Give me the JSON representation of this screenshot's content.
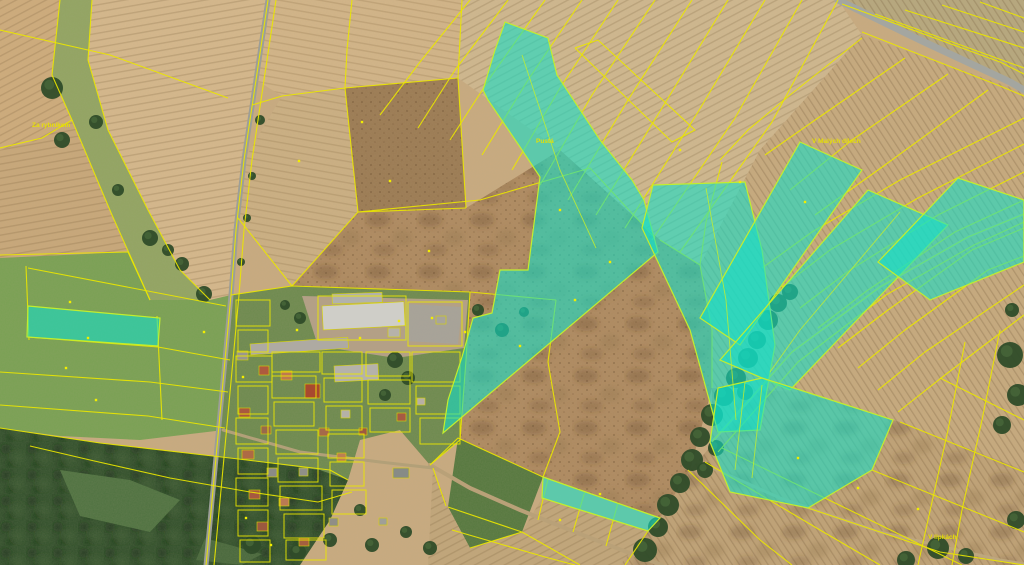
{
  "map": {
    "width": 1024,
    "height": 565,
    "base_color": "#c9ab80",
    "line_color": "#eae600",
    "highlight_fill": "#12e0c9",
    "highlight_stroke": "#c2ee2e",
    "label_color": "#e8e200",
    "marker_color": "#f2ee00",
    "fields": [
      {
        "name": "topleft-corner",
        "points": "0,0 60,0 52,75 72,120 40,140 0,150",
        "fill": "#cfac7c",
        "textures": [
          "rows60"
        ]
      },
      {
        "name": "green-corridor",
        "points": "60,0 92,0 88,60 108,130 148,210 180,270 210,300 150,300 112,215 72,120 52,75",
        "fill": "#92a562",
        "textures": []
      },
      {
        "name": "topleft-big",
        "points": "92,0 268,0 256,80 244,160 236,230 231,295 210,300 180,270 148,210 108,130 88,60",
        "fill": "#d6b88c",
        "textures": [
          "rows80"
        ]
      },
      {
        "name": "left-mid",
        "points": "0,150 40,140 72,120 112,215 128,252 28,258 0,258",
        "fill": "#c9a87a",
        "textures": [
          "rows80"
        ]
      },
      {
        "name": "meadow",
        "points": "0,258 128,252 150,300 210,300 231,295 228,380 224,430 140,440 60,436 0,428",
        "fill": "#79a153",
        "textures": []
      },
      {
        "name": "top-mid",
        "points": "268,0 462,0 458,78 345,88 282,96 256,80",
        "fill": "#d3b588",
        "textures": [
          "rows100"
        ]
      },
      {
        "name": "mid-strip",
        "points": "282,96 345,88 358,212 292,286 238,218 244,160",
        "fill": "#ccb083",
        "textures": [
          "rows100"
        ]
      },
      {
        "name": "brown-top",
        "points": "345,88 458,78 466,208 358,212",
        "fill": "#9c7b53",
        "textures": [
          "dots"
        ]
      },
      {
        "name": "top-center-right",
        "points": "462,0 838,0 862,35 760,150 700,265 660,240 560,150 458,78",
        "fill": "#d0b88f",
        "textures": [
          "rows60"
        ]
      },
      {
        "name": "ne-corner",
        "points": "842,0 1024,0 1024,88",
        "fill": "#b7a87e",
        "textures": [
          "rowsNeg"
        ]
      },
      {
        "name": "right-mid",
        "points": "862,35 1024,92 1024,470 900,422 800,392 712,388 712,330 700,265 760,150",
        "fill": "#c7aa7e",
        "textures": [
          "rowsNeg"
        ]
      },
      {
        "name": "rough-center",
        "points": "358,212 466,208 560,150 660,240 700,265 712,330 712,388 690,470 660,518 543,477 458,438 430,465 400,430 292,286",
        "fill": "#af8a60",
        "textures": [
          "dots",
          "mottle"
        ]
      },
      {
        "name": "green-bottom",
        "points": "458,438 543,477 522,532 470,548 448,507",
        "fill": "#55783e",
        "textures": []
      },
      {
        "name": "bottom-center",
        "points": "433,468 448,507 470,548 522,532 542,498 648,531 620,565 428,565",
        "fill": "#c2a67a",
        "textures": [
          "rows60"
        ]
      },
      {
        "name": "bottom-right",
        "points": "712,388 800,392 900,422 1024,470 1024,565 620,565 648,531 660,518 690,470 712,445",
        "fill": "#c0a276",
        "textures": [
          "rowsNeg",
          "mottle"
        ]
      },
      {
        "name": "village-gardens",
        "points": "231,295 292,286 470,292 466,360 460,440 430,465 400,430 360,440 348,480 330,520 300,565 206,565 213,490 219,425 225,360",
        "fill": "#6d8a4e",
        "textures": []
      },
      {
        "name": "farmyard",
        "points": "302,296 468,300 464,348 396,358 318,346",
        "fill": "#b4a086",
        "textures": []
      },
      {
        "name": "parking",
        "points": "406,304 462,307 458,344 404,341",
        "fill": "#a7a39a",
        "textures": []
      },
      {
        "name": "forest",
        "points": "0,428 100,443 230,458 320,470 348,480 330,520 300,565 0,565",
        "fill": "#31502b",
        "textures": [
          "canopy"
        ]
      },
      {
        "name": "glade-1",
        "points": "60,470 130,480 180,500 150,532 80,516",
        "fill": "#4e7240",
        "textures": []
      },
      {
        "name": "glade-2",
        "points": "205,538 262,554 242,565 196,560",
        "fill": "#47683b",
        "textures": []
      }
    ],
    "roads": [
      {
        "name": "main-road",
        "points": "268,0 256,80 244,160 236,230 231,295 225,360 219,425 213,490 207,555 206,565",
        "color": "#9c9e98",
        "width": 5
      },
      {
        "name": "highway-ne",
        "points": "838,0 920,40 1010,82 1024,90",
        "color": "#a4a6a0",
        "width": 7
      },
      {
        "name": "dirt-path-bottom",
        "points": "430,465 470,488 520,510 575,532 640,557 662,565",
        "color": "#b9a178",
        "width": 4
      },
      {
        "name": "dirt-path-right",
        "points": "690,458 780,498 880,532 1000,560 1024,564",
        "color": "#bda77e",
        "width": 3
      },
      {
        "name": "creek-track",
        "points": "712,442 792,352 880,287 968,237 1024,214",
        "color": "#c6ae83",
        "width": 3
      },
      {
        "name": "village-cross-street",
        "points": "223,430 300,452 380,462 433,468",
        "color": "#b2a078",
        "width": 3
      }
    ],
    "trees": [
      [
        645,
        550,
        12
      ],
      [
        658,
        527,
        10
      ],
      [
        668,
        505,
        11
      ],
      [
        680,
        483,
        10
      ],
      [
        692,
        460,
        11
      ],
      [
        700,
        437,
        10
      ],
      [
        712,
        415,
        11
      ],
      [
        724,
        396,
        10
      ],
      [
        736,
        378,
        10
      ],
      [
        748,
        358,
        10
      ],
      [
        757,
        340,
        9
      ],
      [
        768,
        320,
        10
      ],
      [
        778,
        303,
        9
      ],
      [
        790,
        292,
        8
      ],
      [
        705,
        470,
        8
      ],
      [
        716,
        448,
        8
      ],
      [
        745,
        392,
        8
      ],
      [
        52,
        88,
        11
      ],
      [
        62,
        140,
        8
      ],
      [
        96,
        122,
        7
      ],
      [
        118,
        190,
        6
      ],
      [
        150,
        238,
        8
      ],
      [
        182,
        264,
        7
      ],
      [
        204,
        294,
        8
      ],
      [
        168,
        250,
        6
      ],
      [
        260,
        120,
        5
      ],
      [
        252,
        176,
        4
      ],
      [
        247,
        218,
        4
      ],
      [
        241,
        262,
        4
      ],
      [
        1010,
        355,
        13
      ],
      [
        1018,
        395,
        11
      ],
      [
        1002,
        425,
        9
      ],
      [
        1012,
        310,
        7
      ],
      [
        938,
        548,
        11
      ],
      [
        906,
        560,
        9
      ],
      [
        1016,
        520,
        9
      ],
      [
        966,
        556,
        8
      ],
      [
        252,
        545,
        9
      ],
      [
        298,
        552,
        8
      ],
      [
        330,
        540,
        7
      ],
      [
        372,
        545,
        7
      ],
      [
        406,
        532,
        6
      ],
      [
        430,
        548,
        7
      ],
      [
        360,
        510,
        6
      ],
      [
        395,
        360,
        8
      ],
      [
        408,
        378,
        7
      ],
      [
        385,
        395,
        6
      ],
      [
        300,
        318,
        6
      ],
      [
        285,
        305,
        5
      ],
      [
        478,
        310,
        6
      ],
      [
        502,
        330,
        7
      ],
      [
        524,
        312,
        5
      ]
    ],
    "buildings": [
      {
        "x": 322,
        "y": 306,
        "w": 82,
        "h": 24,
        "fill": "#cfcec8",
        "rot": -3
      },
      {
        "x": 332,
        "y": 294,
        "w": 50,
        "h": 10,
        "fill": "#b2b2ac",
        "rot": -2
      },
      {
        "x": 250,
        "y": 344,
        "w": 98,
        "h": 11,
        "fill": "#aeaaa2",
        "rot": -4
      },
      {
        "x": 334,
        "y": 366,
        "w": 44,
        "h": 16,
        "fill": "#b5b2aa",
        "rot": -3
      },
      {
        "x": 305,
        "y": 384,
        "w": 15,
        "h": 14,
        "fill": "#a8492f",
        "rot": 0
      },
      {
        "x": 237,
        "y": 351,
        "w": 11,
        "h": 9,
        "fill": "#9a968e",
        "rot": 0
      },
      {
        "x": 259,
        "y": 366,
        "w": 10,
        "h": 9,
        "fill": "#ad5a3e",
        "rot": 0
      },
      {
        "x": 281,
        "y": 371,
        "w": 11,
        "h": 9,
        "fill": "#bd7950",
        "rot": 0
      },
      {
        "x": 239,
        "y": 408,
        "w": 11,
        "h": 9,
        "fill": "#a9593f",
        "rot": 0
      },
      {
        "x": 261,
        "y": 426,
        "w": 10,
        "h": 8,
        "fill": "#99694b",
        "rot": 0
      },
      {
        "x": 242,
        "y": 450,
        "w": 12,
        "h": 9,
        "fill": "#ae6a45",
        "rot": 0
      },
      {
        "x": 267,
        "y": 468,
        "w": 10,
        "h": 9,
        "fill": "#8b8b85",
        "rot": 0
      },
      {
        "x": 249,
        "y": 490,
        "w": 11,
        "h": 9,
        "fill": "#a65940",
        "rot": 0
      },
      {
        "x": 279,
        "y": 498,
        "w": 10,
        "h": 8,
        "fill": "#ba7a53",
        "rot": 0
      },
      {
        "x": 257,
        "y": 522,
        "w": 11,
        "h": 9,
        "fill": "#9b593f",
        "rot": 0
      },
      {
        "x": 299,
        "y": 468,
        "w": 9,
        "h": 8,
        "fill": "#8f8f88",
        "rot": 0
      },
      {
        "x": 319,
        "y": 428,
        "w": 10,
        "h": 8,
        "fill": "#a5694a",
        "rot": 0
      },
      {
        "x": 341,
        "y": 410,
        "w": 9,
        "h": 8,
        "fill": "#b5b1a8",
        "rot": 0
      },
      {
        "x": 359,
        "y": 428,
        "w": 8,
        "h": 7,
        "fill": "#9f5940",
        "rot": 0
      },
      {
        "x": 337,
        "y": 453,
        "w": 9,
        "h": 8,
        "fill": "#bd7f53",
        "rot": 0
      },
      {
        "x": 388,
        "y": 328,
        "w": 12,
        "h": 9,
        "fill": "#b6b2aa",
        "rot": 0
      },
      {
        "x": 299,
        "y": 538,
        "w": 10,
        "h": 8,
        "fill": "#a55f3f",
        "rot": 0
      },
      {
        "x": 329,
        "y": 518,
        "w": 9,
        "h": 8,
        "fill": "#908e86",
        "rot": 0
      },
      {
        "x": 397,
        "y": 413,
        "w": 9,
        "h": 8,
        "fill": "#a65b43",
        "rot": 0
      },
      {
        "x": 417,
        "y": 398,
        "w": 8,
        "h": 7,
        "fill": "#b7afa5",
        "rot": 0
      },
      {
        "x": 379,
        "y": 518,
        "w": 8,
        "h": 7,
        "fill": "#9f9f98",
        "rot": 0
      },
      {
        "x": 393,
        "y": 468,
        "w": 16,
        "h": 10,
        "fill": "#878b86",
        "rot": 0
      },
      {
        "x": 436,
        "y": 316,
        "w": 10,
        "h": 8,
        "fill": "#a8a49c",
        "rot": 0
      }
    ],
    "parcel_lines": [
      "0,30 110,55 228,98",
      "0,148 42,138 72,120",
      "60,0 52,75 72,120 112,215 150,300",
      "92,0 88,60 108,130 148,210 180,270 210,300",
      "0,255 128,252 150,300",
      "28,268 226,306",
      "27,337 158,347 230,360",
      "0,372 150,382 228,392",
      "0,405 148,416 225,428",
      "26,266 29,340",
      "157,316 162,420",
      "0,428 100,443 230,458 330,470 348,480",
      "30,446 90,460 170,478 250,492 318,502 352,492",
      "268,0 256,80 244,160 236,230 231,295 225,360 219,425 213,490 207,555 206,565",
      "276,0 264,80 252,160 244,230 239,295 233,360 227,425 221,490 215,555 214,565",
      "282,96 345,88 458,78",
      "352,0 347,50 345,88",
      "462,0 458,78 466,208",
      "358,212 466,208",
      "345,88 358,212",
      "252,105 282,96",
      "238,218 292,286 358,212",
      "231,295 292,286 470,292",
      "358,212 480,200 590,168 655,238",
      "660,240 700,265",
      "470,0 420,62 380,115",
      "508,0 455,70 418,128",
      "545,0 492,75 450,140",
      "582,0 528,80 482,155",
      "618,0 560,88 512,170",
      "655,0 592,95 540,185",
      "692,0 628,100 568,200",
      "728,0 662,108 596,215",
      "765,0 698,112 625,228",
      "802,0 735,118 652,240",
      "838,0 772,122 680,252",
      "575,48 598,40 695,130 672,142 575,48",
      "842,4 1000,62 1024,74",
      "862,32 1000,86 1024,96",
      "875,14 1024,68",
      "905,10 1024,48",
      "942,5 1024,32",
      "980,2 1024,18",
      "1024,118 900,180 812,232 762,268",
      "1024,144 918,198 830,250 782,287",
      "1024,172 938,215 850,270 800,308",
      "1024,200 955,232 868,290 818,328",
      "1024,228 972,250 888,310 838,348",
      "1024,256 988,270 905,330 858,368",
      "1024,285 925,352 878,390",
      "1024,315 945,375 898,412",
      "905,58 818,118 765,155",
      "948,74 852,140 790,190",
      "988,90 885,165 815,215",
      "862,38 790,95 748,130 720,160",
      "700,265 712,330 712,388",
      "722,162 706,222 700,265",
      "712,442 792,352 880,287 968,237 1024,214",
      "718,452 798,362 886,295 974,245 1024,222",
      "705,462 820,530 880,565",
      "722,448 870,520 962,565",
      "688,470 760,540 792,565",
      "900,422 1024,472",
      "872,470 1000,522 1024,532",
      "808,508 940,552 1024,565",
      "940,378 1024,420",
      "965,342 948,430 928,520 918,565",
      "1000,330 982,420 962,510 952,565",
      "430,465 458,438 543,477 660,518",
      "542,498 648,531",
      "448,507 522,532 580,565",
      "452,530 545,557 575,565",
      "470,548 522,532",
      "585,491 573,532",
      "618,503 606,546",
      "548,479 538,520",
      "648,531 625,565",
      "433,468 446,506",
      "470,292 466,360 460,440 430,465",
      "470,292 556,300",
      "556,300 548,362 560,432 543,477"
    ],
    "village_parcels": [
      [
        236,
        300,
        34,
        26
      ],
      [
        238,
        330,
        30,
        22
      ],
      [
        236,
        356,
        36,
        26
      ],
      [
        238,
        386,
        30,
        28
      ],
      [
        236,
        418,
        32,
        26
      ],
      [
        238,
        448,
        30,
        26
      ],
      [
        236,
        478,
        32,
        28
      ],
      [
        238,
        510,
        30,
        26
      ],
      [
        240,
        540,
        30,
        22
      ],
      [
        272,
        352,
        48,
        20
      ],
      [
        272,
        376,
        44,
        22
      ],
      [
        274,
        402,
        40,
        24
      ],
      [
        276,
        430,
        42,
        24
      ],
      [
        278,
        458,
        40,
        24
      ],
      [
        280,
        486,
        42,
        24
      ],
      [
        284,
        514,
        40,
        24
      ],
      [
        286,
        540,
        40,
        20
      ],
      [
        322,
        352,
        40,
        22
      ],
      [
        324,
        378,
        38,
        24
      ],
      [
        326,
        406,
        36,
        24
      ],
      [
        328,
        434,
        36,
        24
      ],
      [
        330,
        462,
        34,
        24
      ],
      [
        332,
        490,
        34,
        24
      ],
      [
        318,
        296,
        88,
        44
      ],
      [
        408,
        302,
        54,
        44
      ],
      [
        366,
        352,
        44,
        24
      ],
      [
        368,
        380,
        42,
        24
      ],
      [
        370,
        408,
        40,
        24
      ],
      [
        412,
        352,
        48,
        30
      ],
      [
        416,
        386,
        44,
        28
      ],
      [
        420,
        418,
        40,
        26
      ]
    ],
    "highlight_parcels": [
      {
        "name": "central-wedge",
        "points": "505,22 548,38 557,75 600,140 632,180 644,200 658,252 443,433 448,400 462,357 473,318 492,313 500,270 528,270 540,177 520,147 488,100 483,90 495,50"
      },
      {
        "name": "creek-band",
        "points": "653,185 745,182 762,250 775,345 760,430 718,432 690,330 642,228"
      },
      {
        "name": "ne-strip-1",
        "points": "800,142 862,170 740,345 700,318"
      },
      {
        "name": "ne-strip-2",
        "points": "868,190 948,225 790,390 720,360"
      },
      {
        "name": "right-edge-block",
        "points": "958,178 1024,200 1024,262 930,300 878,262"
      },
      {
        "name": "bottom-right-block",
        "points": "718,388 762,378 800,390 893,420 872,470 808,508 730,492 710,442"
      },
      {
        "name": "meadow-strip",
        "points": "28,306 160,318 158,346 27,337"
      },
      {
        "name": "bottom-center-strip",
        "points": "543,477 660,518 648,531 542,498"
      }
    ],
    "highlight_dividers": [
      "522,55 560,170 596,248",
      "706,188 726,300 736,420",
      "745,382 735,470",
      "762,385 752,478",
      "900,212 800,330 770,372"
    ],
    "markers": [
      [
        70,
        302
      ],
      [
        88,
        338
      ],
      [
        66,
        368
      ],
      [
        96,
        400
      ],
      [
        204,
        332
      ],
      [
        243,
        377
      ],
      [
        297,
        330
      ],
      [
        360,
        338
      ],
      [
        399,
        321
      ],
      [
        432,
        318
      ],
      [
        465,
        332
      ],
      [
        520,
        346
      ],
      [
        575,
        300
      ],
      [
        610,
        262
      ],
      [
        429,
        251
      ],
      [
        390,
        181
      ],
      [
        362,
        122
      ],
      [
        299,
        161
      ],
      [
        560,
        210
      ],
      [
        680,
        150
      ],
      [
        740,
        182
      ],
      [
        805,
        202
      ],
      [
        560,
        520
      ],
      [
        600,
        494
      ],
      [
        798,
        458
      ],
      [
        858,
        488
      ],
      [
        918,
        509
      ],
      [
        246,
        518
      ],
      [
        271,
        545
      ]
    ],
    "labels": [
      {
        "text": "Za rybníkem",
        "x": 32,
        "y": 127
      },
      {
        "text": "Pustá",
        "x": 536,
        "y": 143
      },
      {
        "text": "V Malých dílech",
        "x": 812,
        "y": 143
      },
      {
        "text": "V lipkách",
        "x": 928,
        "y": 539
      }
    ]
  }
}
